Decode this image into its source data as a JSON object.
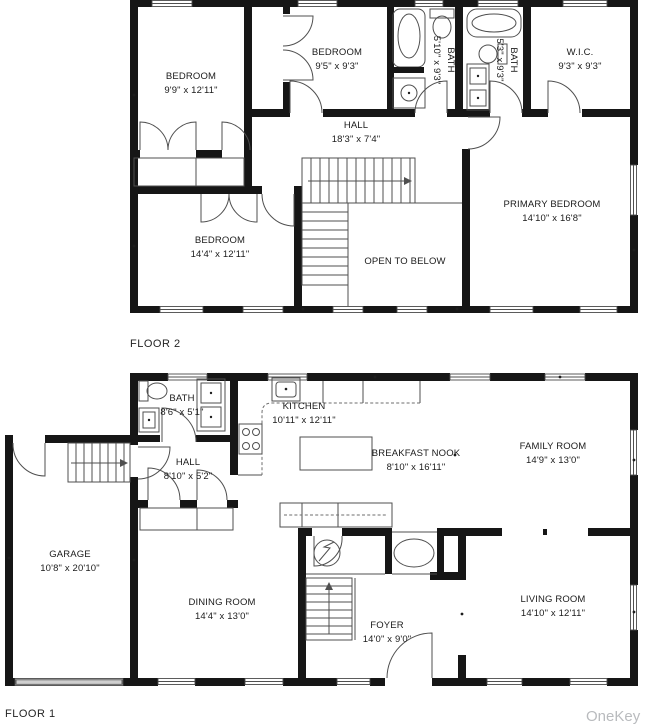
{
  "colors": {
    "wall": "#161616",
    "thin_line": "#4f4f4f",
    "watermark": "#b9bbbe"
  },
  "floor2": {
    "label": "FLOOR 2",
    "rooms": {
      "bedroom_left": {
        "name": "BEDROOM",
        "dims": "9'9\" x 12'11\""
      },
      "bedroom_mid": {
        "name": "BEDROOM",
        "dims": "9'5\" x 9'3\""
      },
      "bath_1": {
        "name": "BATH",
        "dims": "5'10\" x 9'3\""
      },
      "bath_2": {
        "name": "BATH",
        "dims": "5'3\" x 9'3\""
      },
      "wic": {
        "name": "W.I.C.",
        "dims": "9'3\" x 9'3\""
      },
      "hall": {
        "name": "HALL",
        "dims": "18'3\" x 7'4\""
      },
      "primary_bedroom": {
        "name": "PRIMARY BEDROOM",
        "dims": "14'10\" x 16'8\""
      },
      "bedroom_lower": {
        "name": "BEDROOM",
        "dims": "14'4\" x 12'11\""
      },
      "open_to_below": {
        "name": "OPEN TO BELOW"
      }
    }
  },
  "floor1": {
    "label": "FLOOR 1",
    "rooms": {
      "bath": {
        "name": "BATH",
        "dims": "8'6\" x 5'1\""
      },
      "kitchen": {
        "name": "KITCHEN",
        "dims": "10'11\" x 12'11\""
      },
      "hall": {
        "name": "HALL",
        "dims": "8'10\" x 5'2\""
      },
      "breakfast_nook": {
        "name": "BREAKFAST NOOK",
        "dims": "8'10\" x 16'11\""
      },
      "family_room": {
        "name": "FAMILY ROOM",
        "dims": "14'9\" x 13'0\""
      },
      "garage": {
        "name": "GARAGE",
        "dims": "10'8\" x 20'10\""
      },
      "dining_room": {
        "name": "DINING ROOM",
        "dims": "14'4\" x 13'0\""
      },
      "foyer": {
        "name": "FOYER",
        "dims": "14'0\" x 9'0\""
      },
      "living_room": {
        "name": "LIVING ROOM",
        "dims": "14'10\" x 12'11\""
      }
    }
  },
  "watermark": "OneKey ML"
}
